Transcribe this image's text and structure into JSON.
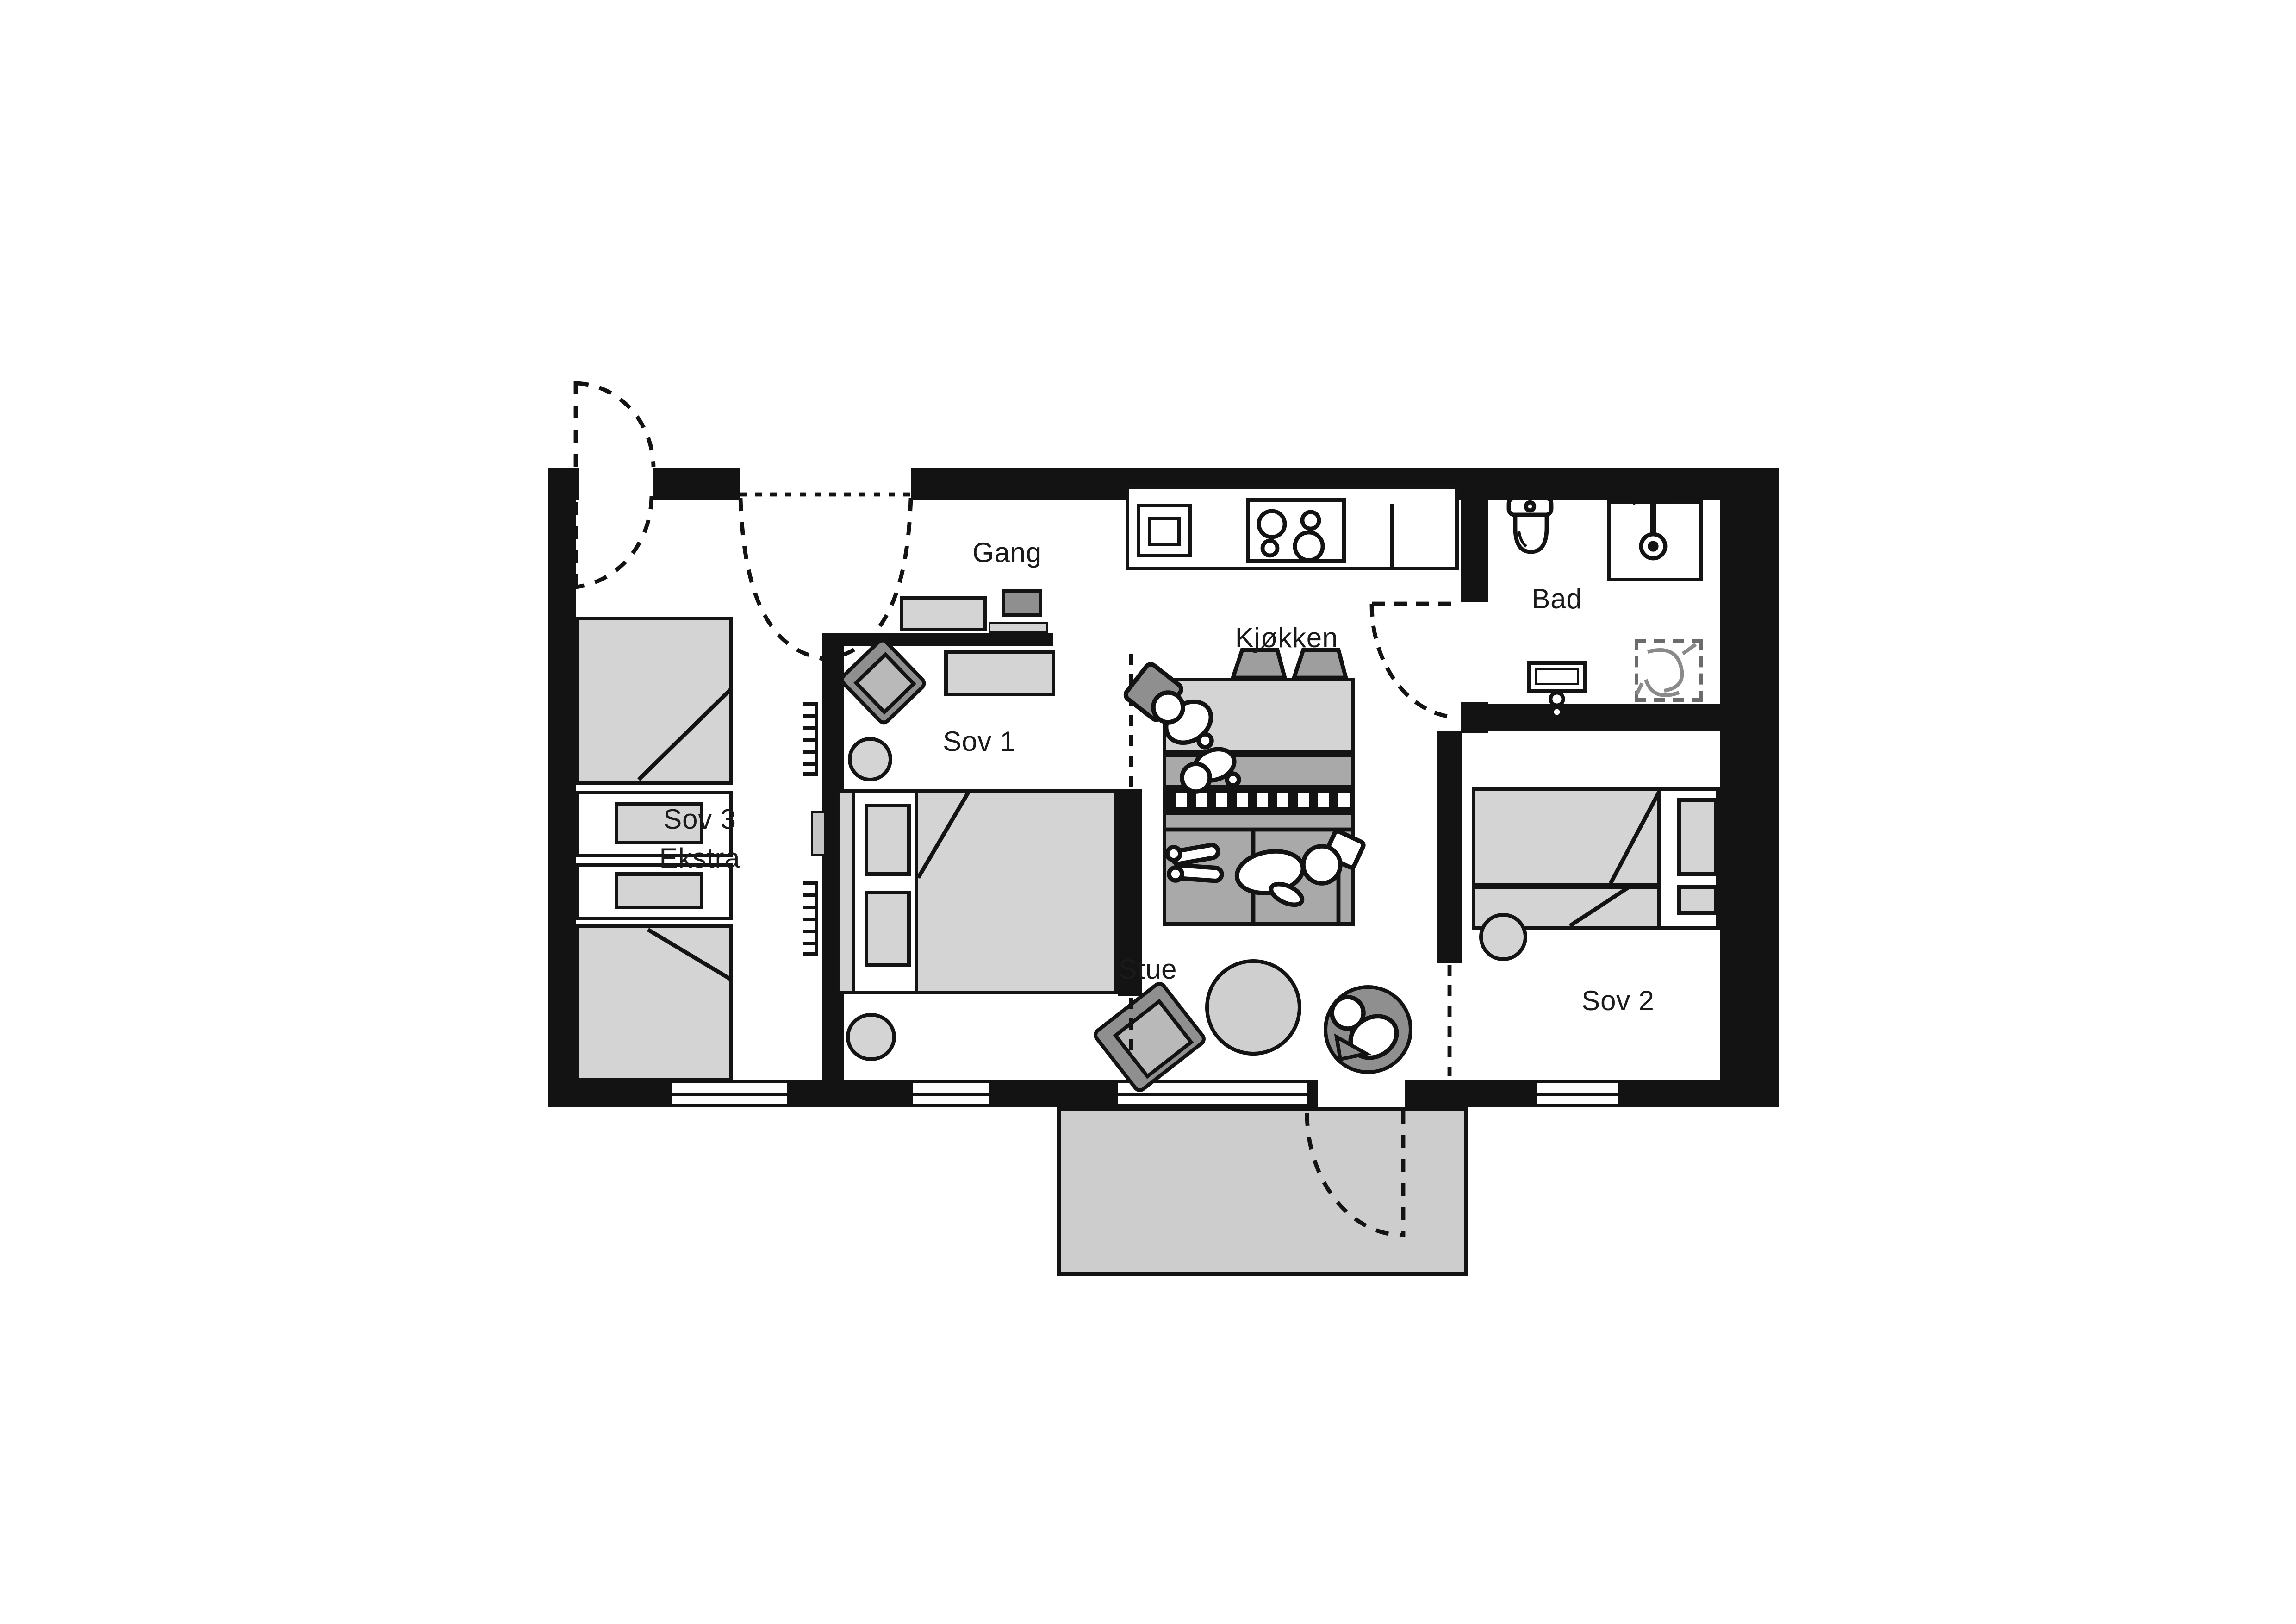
{
  "title": "Apartment floor plan",
  "rooms": {
    "gang": {
      "label": "Gang"
    },
    "kjokken": {
      "label": "Kjøkken"
    },
    "bad": {
      "label": "Bad"
    },
    "sov1": {
      "label": "Sov 1"
    },
    "sov2": {
      "label": "Sov 2"
    },
    "sov3": {
      "label_line1": "Sov 3",
      "label_line2": "Ekstra"
    },
    "stue": {
      "label": "Stue"
    }
  },
  "colors": {
    "wall": "#131313",
    "furniture_light": "#d4d4d4",
    "furniture_mid": "#a9a9a9",
    "furniture_dark": "#8f8f8f",
    "balcony": "#cdcdcd",
    "background": "#ffffff"
  }
}
